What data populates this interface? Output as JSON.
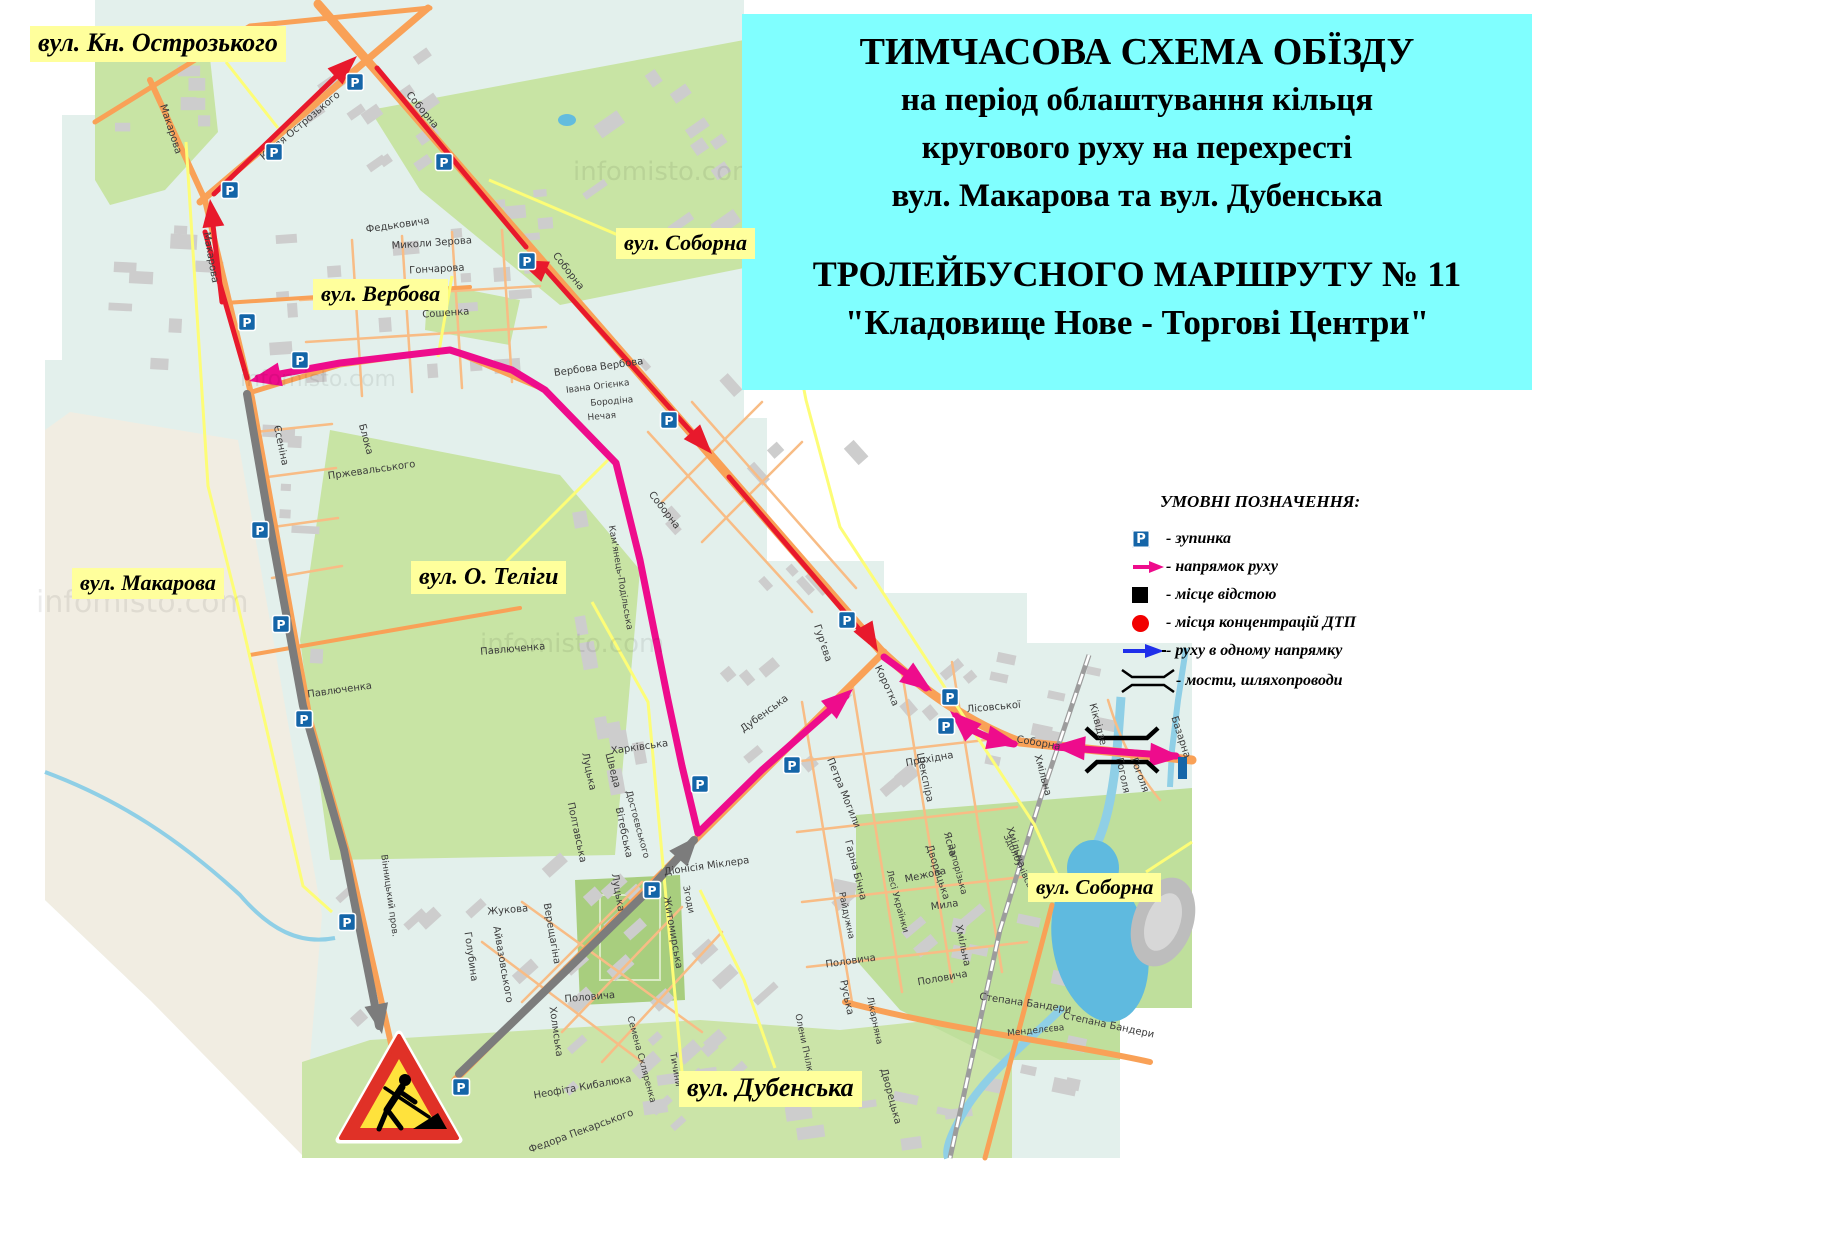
{
  "title_box": {
    "lines": [
      "ТИМЧАСОВА  СХЕМА  ОБЇЗДУ",
      "на період облаштування кільця",
      "кругового руху на перехресті",
      "вул. Макарова та вул. Дубенська"
    ],
    "route_lines": [
      "ТРОЛЕЙБУСНОГО МАРШРУТУ № 11",
      "\"Кладовище Нове - Торгові Центри\""
    ]
  },
  "legend": {
    "title": "УМОВНІ ПОЗНАЧЕННЯ:",
    "items": [
      {
        "icon": "bus-stop-icon",
        "label": "- зупинка"
      },
      {
        "icon": "direction-arrow-icon",
        "label": "- напрямок руху"
      },
      {
        "icon": "layover-square-icon",
        "label": "- місце відстою"
      },
      {
        "icon": "accident-circle-icon",
        "label": "- місця концентрацій ДТП"
      },
      {
        "icon": "one-way-arrow-icon",
        "label": "- руху в одному напрямку"
      },
      {
        "icon": "bridge-icon",
        "label": "- мости, шляхопроводи"
      }
    ]
  },
  "street_labels": [
    {
      "text": "вул. Кн. Острозького",
      "x": 30,
      "y": 26,
      "fs": 26
    },
    {
      "text": "вул. Соборна",
      "x": 616,
      "y": 228,
      "fs": 22
    },
    {
      "text": "вул. Вербова",
      "x": 313,
      "y": 279,
      "fs": 22
    },
    {
      "text": "вул. Макарова",
      "x": 72,
      "y": 568,
      "fs": 22
    },
    {
      "text": "вул. О. Теліги",
      "x": 411,
      "y": 561,
      "fs": 24
    },
    {
      "text": "вул. Дубенська",
      "x": 679,
      "y": 1071,
      "fs": 26
    },
    {
      "text": "вул. Соборна",
      "x": 1028,
      "y": 873,
      "fs": 21
    }
  ],
  "colors": {
    "title_bg": "#80FFFF",
    "label_bg": "#FFFF9C",
    "detour_magenta": "#EE0C8C",
    "direction_red": "#E8192C",
    "closed_gray": "#7C7C7C",
    "pointer_yellow": "#FDFD77",
    "stop_blue": "#1465A8",
    "map_bg": "#E3F0EC",
    "park_green": "#C8E4A4",
    "water_blue": "#5FBADF",
    "road_orange": "#F9A157",
    "accident_red": "#F20000"
  },
  "map": {
    "stop_glyph": "P",
    "stops": [
      [
        355,
        82
      ],
      [
        274,
        152
      ],
      [
        230,
        190
      ],
      [
        444,
        162
      ],
      [
        527,
        261
      ],
      [
        300,
        360
      ],
      [
        247,
        322
      ],
      [
        669,
        420
      ],
      [
        260,
        530
      ],
      [
        281,
        624
      ],
      [
        304,
        719
      ],
      [
        347,
        922
      ],
      [
        652,
        890
      ],
      [
        461,
        1087
      ],
      [
        792,
        765
      ],
      [
        700,
        784
      ],
      [
        847,
        620
      ],
      [
        950,
        697
      ],
      [
        946,
        726
      ]
    ],
    "watermarks": [
      {
        "text": "infomisto.com",
        "x": 36,
        "y": 612,
        "fs": 30
      },
      {
        "text": "infomisto.com",
        "x": 240,
        "y": 386,
        "fs": 22
      },
      {
        "text": "infomisto.com",
        "x": 573,
        "y": 180,
        "fs": 26
      },
      {
        "text": "infomisto.com",
        "x": 480,
        "y": 652,
        "fs": 26
      }
    ],
    "street_names": [
      {
        "t": "Макарова",
        "x": 168,
        "y": 130,
        "r": 72
      },
      {
        "t": "Макарова",
        "x": 208,
        "y": 258,
        "r": 80
      },
      {
        "t": "Князя Острозького",
        "x": 302,
        "y": 128,
        "r": -40
      },
      {
        "t": "Соборна",
        "x": 420,
        "y": 112,
        "r": 50
      },
      {
        "t": "Соборна",
        "x": 566,
        "y": 273,
        "r": 52
      },
      {
        "t": "Соборна",
        "x": 662,
        "y": 512,
        "r": 52
      },
      {
        "t": "Соборна",
        "x": 1038,
        "y": 746,
        "r": 10
      },
      {
        "t": "Ювілейна",
        "x": 400,
        "y": 291,
        "r": -3
      },
      {
        "t": "Миколи Зерова",
        "x": 432,
        "y": 246,
        "r": -4
      },
      {
        "t": "Гончарова",
        "x": 437,
        "y": 272,
        "r": -3
      },
      {
        "t": "Сошенка",
        "x": 446,
        "y": 316,
        "r": -4
      },
      {
        "t": "Федьковича",
        "x": 398,
        "y": 228,
        "r": -8
      },
      {
        "t": "Вербова",
        "x": 576,
        "y": 373,
        "r": -8
      },
      {
        "t": "Вербова",
        "x": 622,
        "y": 367,
        "r": -8
      },
      {
        "t": "Івана Огієнка",
        "x": 598,
        "y": 389,
        "r": -7,
        "fs": 9
      },
      {
        "t": "Бородіна",
        "x": 612,
        "y": 404,
        "r": -5,
        "fs": 9
      },
      {
        "t": "Нечая",
        "x": 602,
        "y": 419,
        "r": -5,
        "fs": 9
      },
      {
        "t": "Пржевальського",
        "x": 372,
        "y": 473,
        "r": -8
      },
      {
        "t": "Блока",
        "x": 363,
        "y": 440,
        "r": 75
      },
      {
        "t": "Єсеніна",
        "x": 278,
        "y": 446,
        "r": 78
      },
      {
        "t": "Кам'янець-Подільська",
        "x": 618,
        "y": 578,
        "r": 80,
        "fs": 9
      },
      {
        "t": "Павлюченка",
        "x": 340,
        "y": 693,
        "r": -8
      },
      {
        "t": "Павлюченка",
        "x": 513,
        "y": 652,
        "r": -5
      },
      {
        "t": "Гур'єва",
        "x": 820,
        "y": 644,
        "r": 72
      },
      {
        "t": "Дубенська",
        "x": 766,
        "y": 716,
        "r": -36
      },
      {
        "t": "Коротка",
        "x": 884,
        "y": 687,
        "r": 65
      },
      {
        "t": "Петра Могили",
        "x": 841,
        "y": 794,
        "r": 68
      },
      {
        "t": "Прохідна",
        "x": 930,
        "y": 762,
        "r": -10
      },
      {
        "t": "Лісовської",
        "x": 994,
        "y": 710,
        "r": -5
      },
      {
        "t": "Хмільна",
        "x": 1040,
        "y": 776,
        "r": 75
      },
      {
        "t": "Хмільна",
        "x": 1013,
        "y": 848,
        "r": 72
      },
      {
        "t": "Хмільна",
        "x": 960,
        "y": 946,
        "r": 78
      },
      {
        "t": "Кіквідзе",
        "x": 1095,
        "y": 725,
        "r": 75
      },
      {
        "t": "Гоголя",
        "x": 1120,
        "y": 776,
        "r": 78
      },
      {
        "t": "Гоголя",
        "x": 1137,
        "y": 776,
        "r": 70
      },
      {
        "t": "Базарна",
        "x": 1178,
        "y": 738,
        "r": 72
      },
      {
        "t": "Здолбунівська",
        "x": 1018,
        "y": 867,
        "r": 65,
        "fs": 9
      },
      {
        "t": "Степана Бандери",
        "x": 1025,
        "y": 1006,
        "r": 8
      },
      {
        "t": "Степана Бандери",
        "x": 1108,
        "y": 1028,
        "r": 12
      },
      {
        "t": "Менделєєва",
        "x": 1036,
        "y": 1033,
        "r": -6,
        "fs": 9
      },
      {
        "t": "Половича",
        "x": 851,
        "y": 964,
        "r": -8
      },
      {
        "t": "Половича",
        "x": 943,
        "y": 981,
        "r": -10
      },
      {
        "t": "Половича",
        "x": 590,
        "y": 1000,
        "r": -5
      },
      {
        "t": "Жукова",
        "x": 508,
        "y": 913,
        "r": -5
      },
      {
        "t": "Голубина",
        "x": 468,
        "y": 957,
        "r": 82
      },
      {
        "t": "Айвазовського",
        "x": 500,
        "y": 965,
        "r": 80
      },
      {
        "t": "Верещагіна",
        "x": 549,
        "y": 934,
        "r": 80
      },
      {
        "t": "Луцька",
        "x": 615,
        "y": 893,
        "r": 80
      },
      {
        "t": "Житомирська",
        "x": 670,
        "y": 933,
        "r": 80
      },
      {
        "t": "Згоди",
        "x": 686,
        "y": 900,
        "r": 78,
        "fs": 9
      },
      {
        "t": "Діонісія Міклера",
        "x": 707,
        "y": 869,
        "r": -8
      },
      {
        "t": "Вінницький пров.",
        "x": 387,
        "y": 896,
        "r": 82,
        "fs": 9
      },
      {
        "t": "Неофіта Кибалюка",
        "x": 583,
        "y": 1090,
        "r": -10
      },
      {
        "t": "Федора Пекарського",
        "x": 582,
        "y": 1134,
        "r": -20
      },
      {
        "t": "Семена Скляренка",
        "x": 639,
        "y": 1060,
        "r": 75,
        "fs": 9
      },
      {
        "t": "Тичини",
        "x": 673,
        "y": 1070,
        "r": 80,
        "fs": 9
      },
      {
        "t": "Олени Пчілки",
        "x": 802,
        "y": 1046,
        "r": 78,
        "fs": 9
      },
      {
        "t": "Руська",
        "x": 844,
        "y": 998,
        "r": 78
      },
      {
        "t": "Лікарняна",
        "x": 872,
        "y": 1021,
        "r": 78,
        "fs": 9
      },
      {
        "t": "Дворецька",
        "x": 935,
        "y": 873,
        "r": 72
      },
      {
        "t": "Дворецька",
        "x": 888,
        "y": 1097,
        "r": 75
      },
      {
        "t": "Запорізька",
        "x": 955,
        "y": 870,
        "r": 75,
        "fs": 9
      },
      {
        "t": "Межова",
        "x": 926,
        "y": 878,
        "r": -12
      },
      {
        "t": "Мила",
        "x": 945,
        "y": 908,
        "r": -8
      },
      {
        "t": "Лесі Українки",
        "x": 895,
        "y": 902,
        "r": 75,
        "fs": 9
      },
      {
        "t": "Шекспіра",
        "x": 922,
        "y": 778,
        "r": 78
      },
      {
        "t": "Ясна",
        "x": 947,
        "y": 845,
        "r": 75
      },
      {
        "t": "Бічна",
        "x": 857,
        "y": 887,
        "r": 75
      },
      {
        "t": "Райдужна",
        "x": 844,
        "y": 916,
        "r": 78,
        "fs": 9
      },
      {
        "t": "Гарна",
        "x": 849,
        "y": 856,
        "r": 75
      },
      {
        "t": "Харківська",
        "x": 640,
        "y": 750,
        "r": -8
      },
      {
        "t": "Шведа",
        "x": 610,
        "y": 771,
        "r": 75
      },
      {
        "t": "Луцька",
        "x": 586,
        "y": 772,
        "r": 78
      },
      {
        "t": "Полтавська",
        "x": 574,
        "y": 833,
        "r": 78
      },
      {
        "t": "Вітебська",
        "x": 621,
        "y": 833,
        "r": 78
      },
      {
        "t": "Достоєвського",
        "x": 635,
        "y": 825,
        "r": 75,
        "fs": 9
      },
      {
        "t": "Холмська",
        "x": 553,
        "y": 1032,
        "r": 82
      }
    ]
  }
}
